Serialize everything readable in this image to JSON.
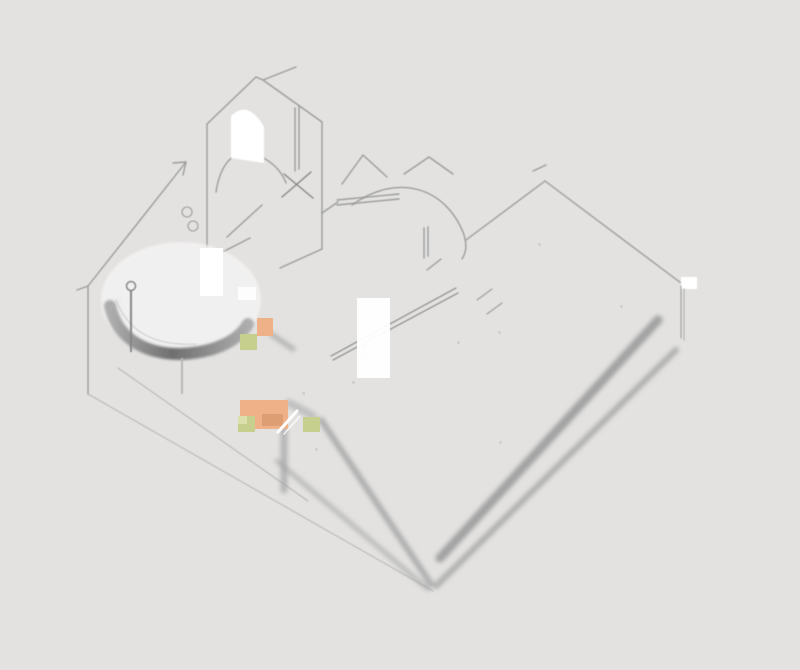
{
  "scene": {
    "background": "#e3e2e1"
  },
  "colors": {
    "line": "#9c9c9c",
    "line_dark": "#868686",
    "line_light": "#b8b8b8",
    "shadow_band": "#a3a3a3",
    "shadow_band_dark": "#929292",
    "speck": "#c9c9c9",
    "highlight_white": "#ffffff",
    "table_top": "#f4f3f2",
    "table_shadow_dark": "#6f6f6f",
    "table_shadow_light": "#adadad",
    "cabinet_orange": "#efb187",
    "cabinet_orange_dark": "#dd9e74",
    "accent_green": "#c6cf8e",
    "accent_green_light": "#dadfab"
  }
}
